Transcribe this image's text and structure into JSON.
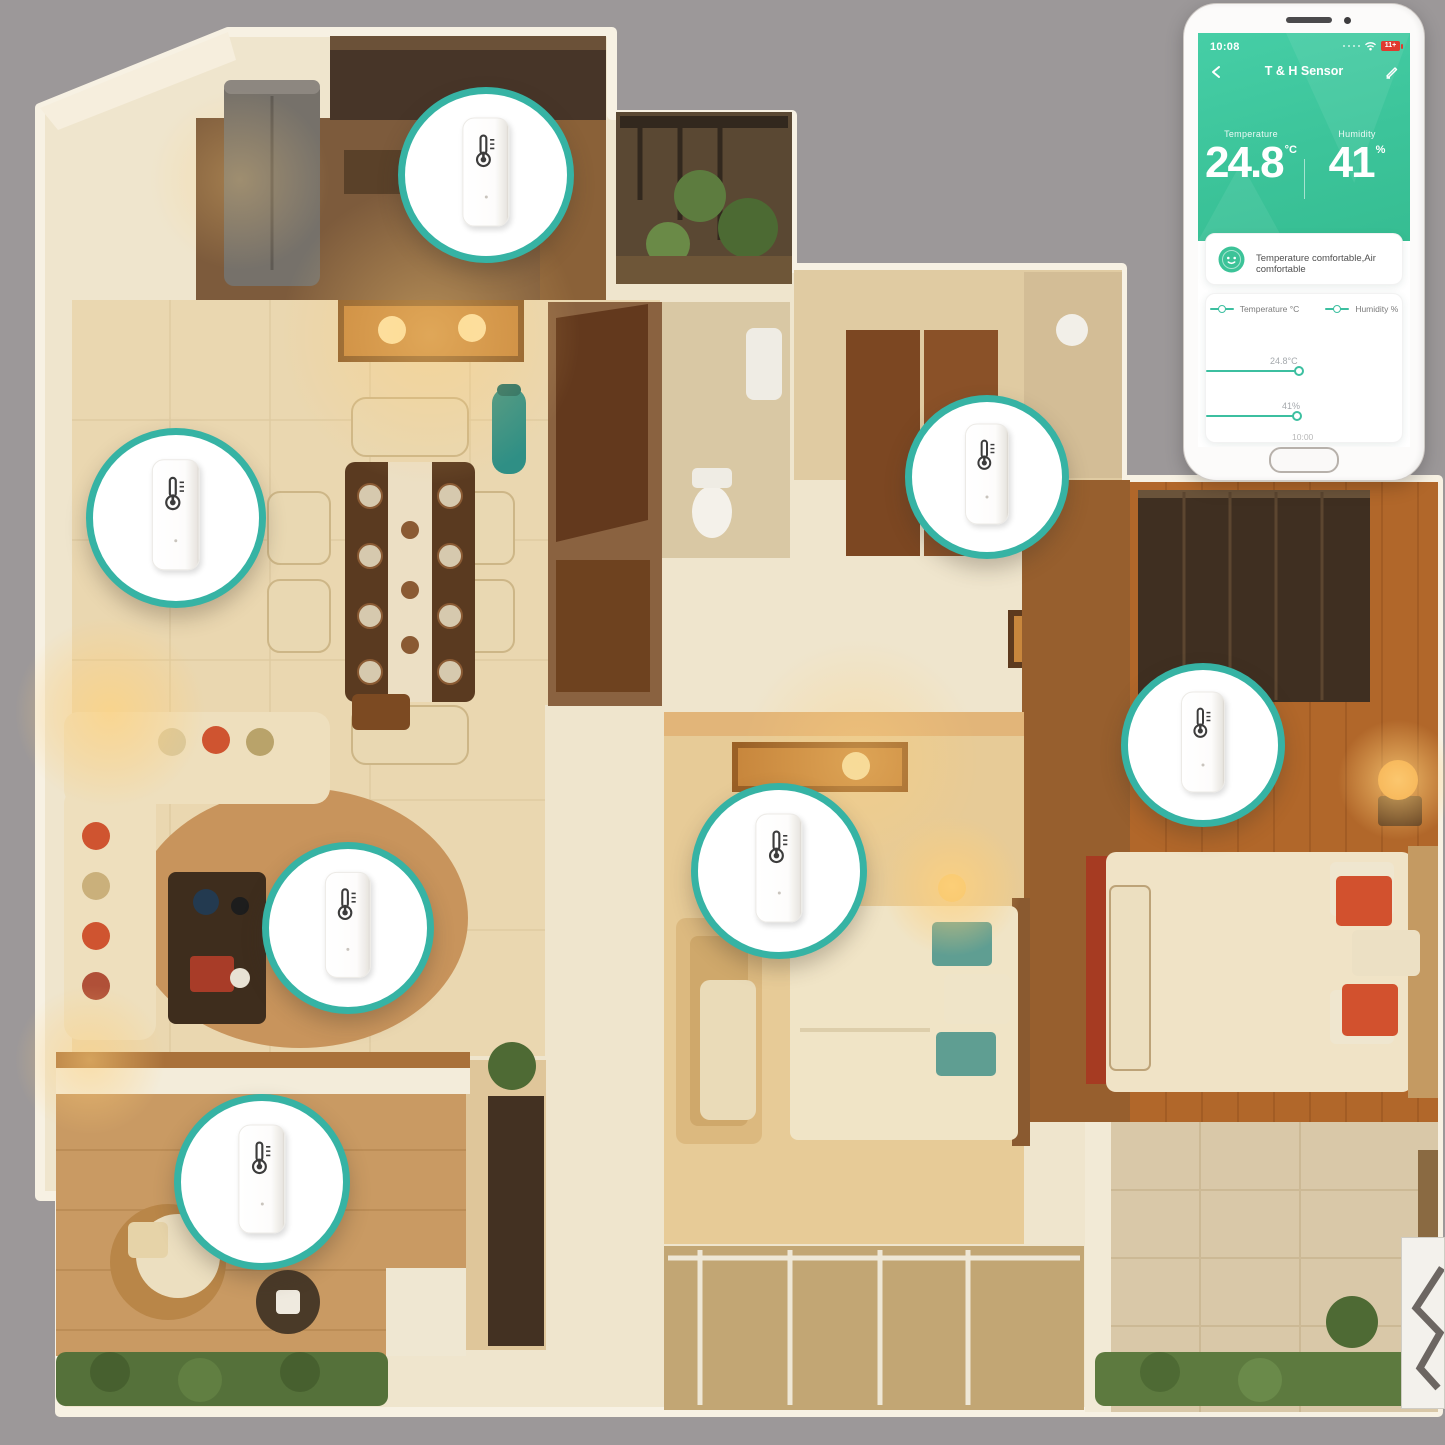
{
  "scene": {
    "description": "Isometric cutaway apartment view with smart temperature and humidity sensors placed in seven rooms, plus companion app phone mockup",
    "sensor_count": 7,
    "callout_ring_color": "#36b3a4"
  },
  "phone": {
    "status_bar": {
      "time": "10:08",
      "battery_label": "11+"
    },
    "nav": {
      "title": "T & H Sensor"
    },
    "readings": {
      "temperature_label": "Temperature",
      "temperature_value": "24.8",
      "temperature_unit": "°C",
      "humidity_label": "Humidity",
      "humidity_value": "41",
      "humidity_unit": "%"
    },
    "comfort_card": {
      "text": "Temperature comfortable,Air comfortable"
    },
    "chart_card": {
      "legend_temperature": "Temperature °C",
      "legend_humidity": "Humidity %",
      "temp_point_label": "24.8°C",
      "humidity_point_label": "41%",
      "x_tick": "10:00"
    },
    "colors": {
      "header_green": "#3cc49a",
      "accent_teal": "#3cbfa0"
    }
  },
  "chart_data": {
    "type": "line",
    "x": [
      "10:00"
    ],
    "series": [
      {
        "name": "Temperature °C",
        "values": [
          24.8
        ]
      },
      {
        "name": "Humidity %",
        "values": [
          41
        ]
      }
    ],
    "title": "",
    "xlabel": "",
    "ylabel": "",
    "legend_position": "top",
    "grid": false
  }
}
